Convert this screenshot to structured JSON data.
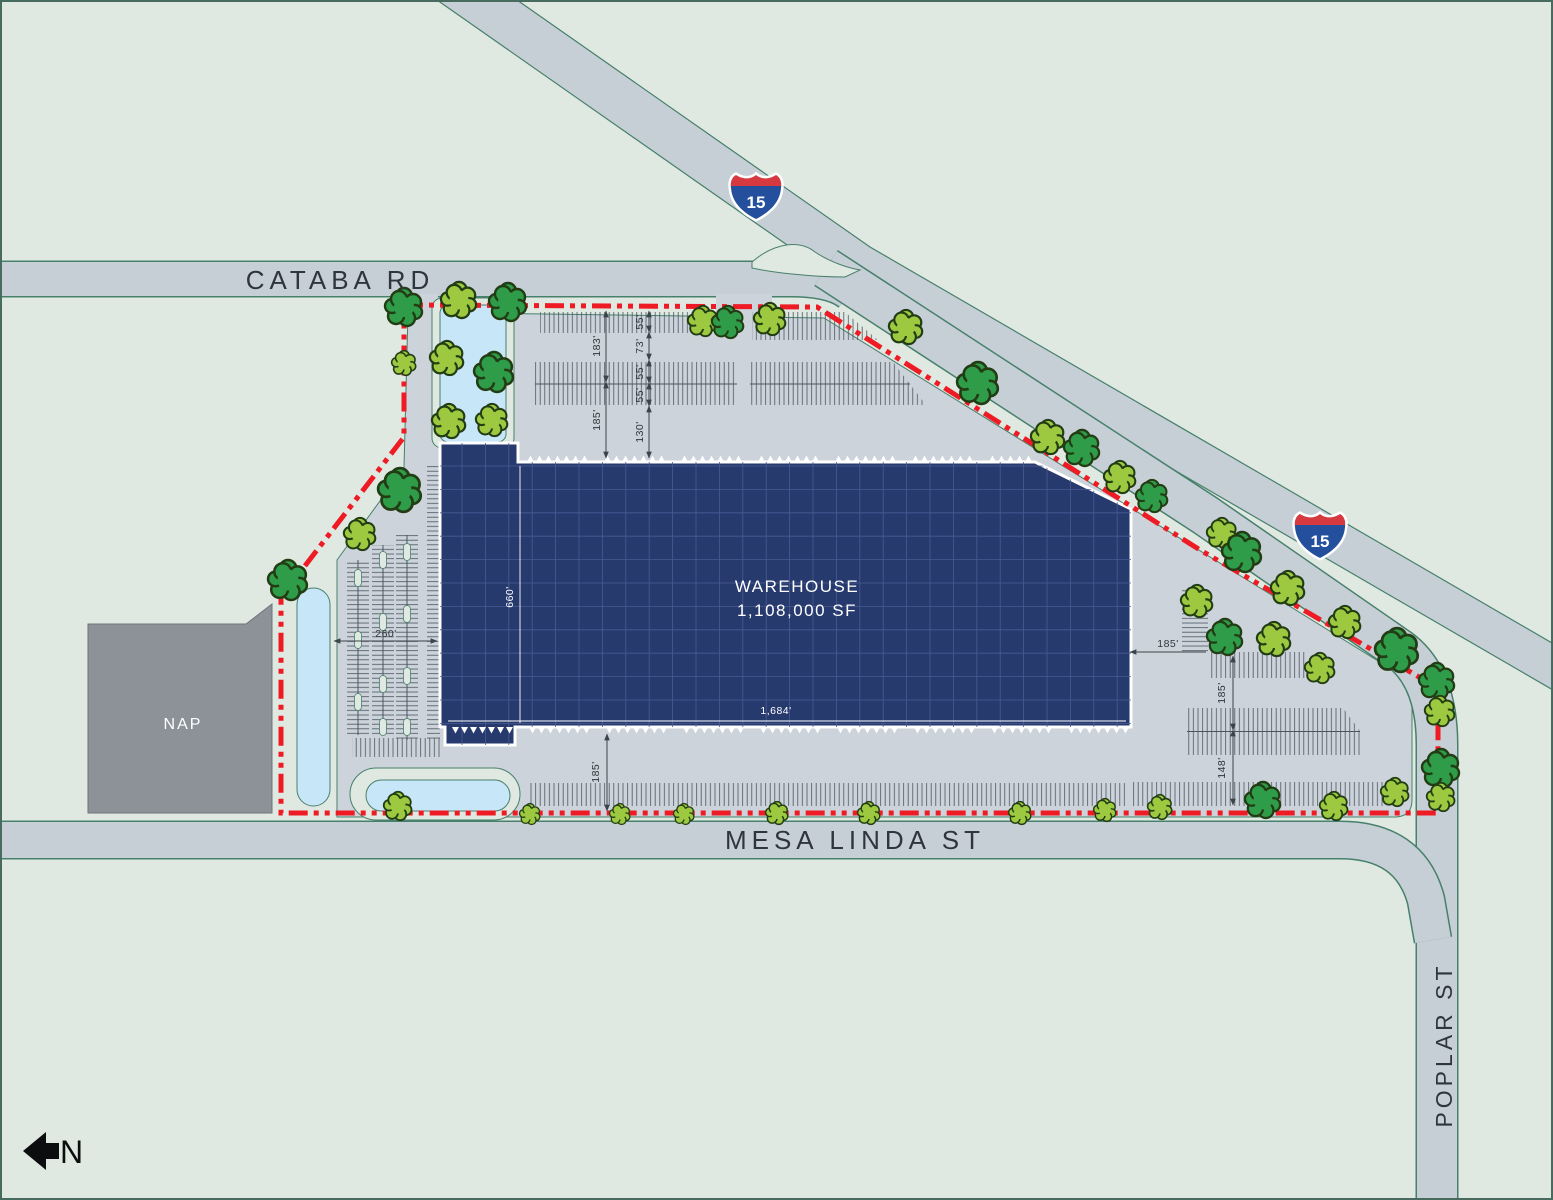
{
  "map": {
    "roads": {
      "cataba_rd": "CATABA RD",
      "mesa_linda_st": "MESA LINDA ST",
      "poplar_st": "POPLAR ST"
    },
    "interstate": {
      "number": "15"
    },
    "warehouse": {
      "name": "WAREHOUSE",
      "size": "1,108,000 SF",
      "width_label": "1,684'",
      "depth_label": "660'"
    },
    "nap": {
      "label": "NAP"
    },
    "compass": {
      "label": "N"
    },
    "dims": {
      "north_left_a": "183'",
      "north_left_b": "185'",
      "north_mid_a": "55'",
      "north_mid_b": "73'",
      "north_mid_c": "55'",
      "north_mid_d": "55'",
      "north_mid_e": "130'",
      "south_depth": "185'",
      "west_court": "260'",
      "east_h": "185'",
      "east_v_a": "185'",
      "east_v_b": "148'"
    },
    "colors": {
      "boundary_red": "#ee1b24",
      "warehouse_navy": "#273a6e",
      "road_gray": "#c6ced6",
      "paving_gray": "#ccd3da",
      "pond_blue": "#c7e6f8",
      "tree_dark": "#2f9c49",
      "tree_light": "#9cc93f",
      "background_green": "#dfe8e1"
    }
  }
}
